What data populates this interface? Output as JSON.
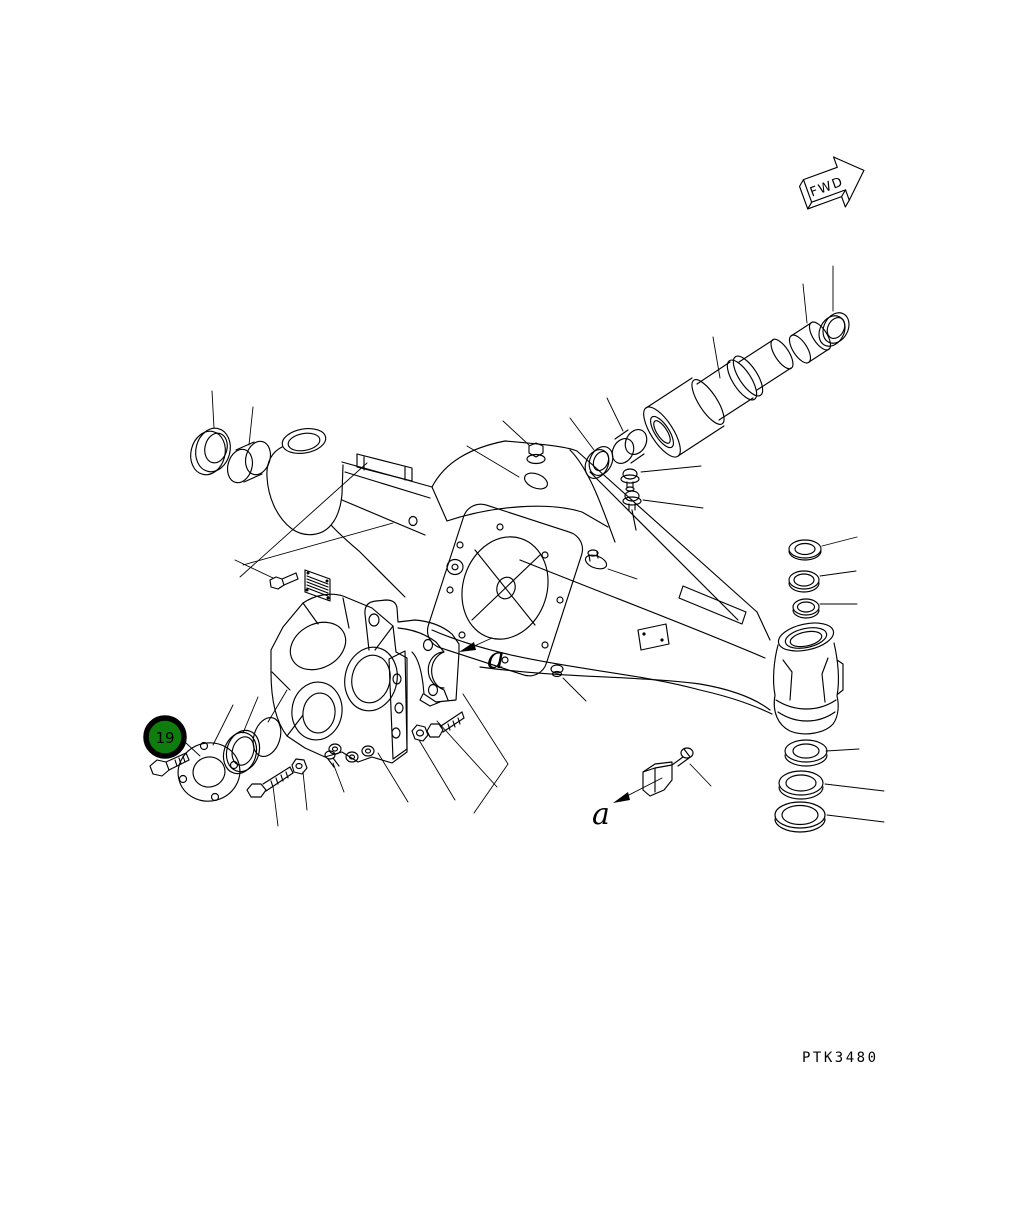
{
  "page": {
    "background_color": "#ffffff",
    "line_color": "#000000"
  },
  "direction_indicator": {
    "label": "FWD"
  },
  "part_callout": {
    "number": "19",
    "fill_color": "#0e7d0e",
    "ring_color": "#000000",
    "text_color": "#ffffff"
  },
  "view_labels": [
    {
      "text": "a"
    },
    {
      "text": "a"
    }
  ],
  "drawing_number": {
    "text": "PTK3480"
  },
  "parts_depicted": [
    "bushing",
    "seal-ring",
    "axle-housing",
    "spindle",
    "collar-bushing",
    "hex-plug",
    "grease-fitting",
    "breather",
    "identification-plate",
    "differential-flange",
    "pinion-carrier",
    "cap-bracket",
    "cover-flange",
    "o-ring",
    "hex-bolt",
    "nut",
    "bearing-ring",
    "oil-seal",
    "stopper-bracket",
    "drain-plug"
  ]
}
